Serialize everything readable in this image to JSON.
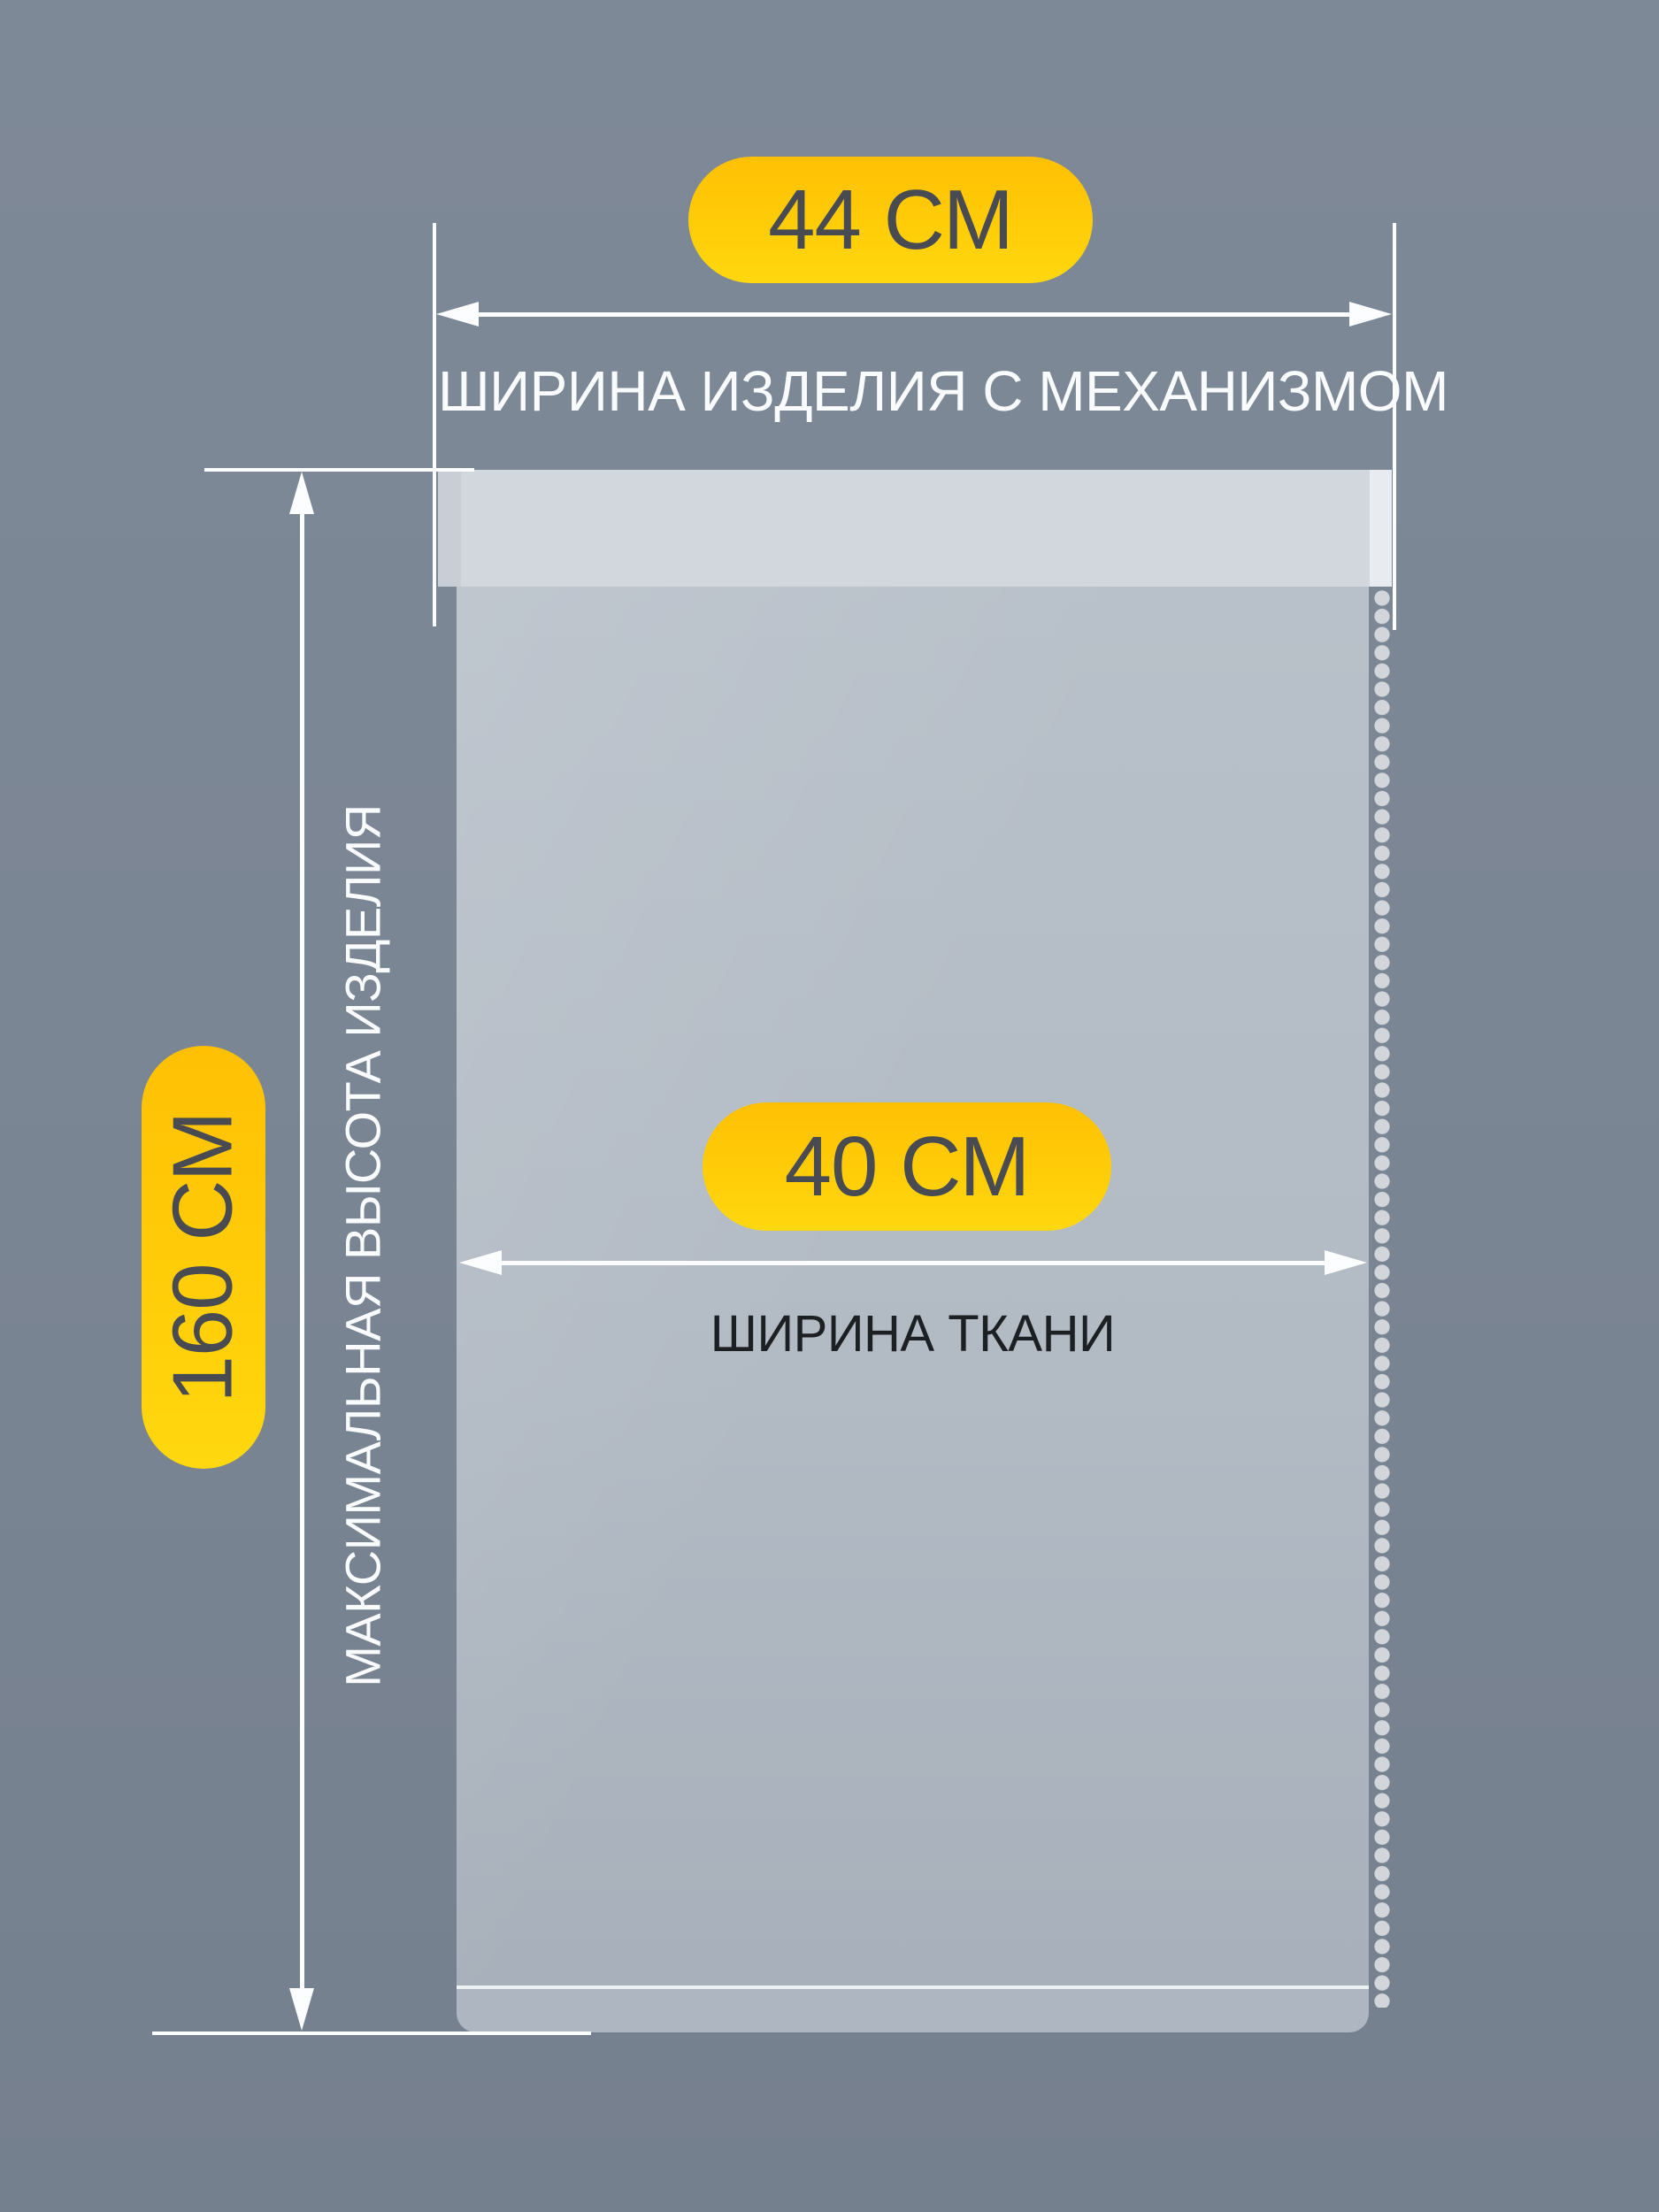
{
  "badges": {
    "product_width": {
      "label": "44 СМ"
    },
    "fabric_width": {
      "label": "40 СМ"
    },
    "max_height": {
      "label": "160 СМ"
    }
  },
  "labels": {
    "product_width": "ШИРИНА ИЗДЕЛИЯ С МЕХАНИЗМОМ",
    "fabric_width": "ШИРИНА ТКАНИ",
    "max_height": "МАКСИМАЛЬНАЯ ВЫСОТА ИЗДЕЛИЯ"
  },
  "colors": {
    "background": "#7d8896",
    "accent_yellow_top": "#ffc004",
    "accent_yellow_bottom": "#ffd80f",
    "badge_text": "#484c52",
    "cassette": "#d2d7dd",
    "fabric": "#aeb7c1",
    "dimension_lines": "#fcfdfe",
    "label_light": "#fafbfc",
    "label_dark": "#1d2023"
  }
}
